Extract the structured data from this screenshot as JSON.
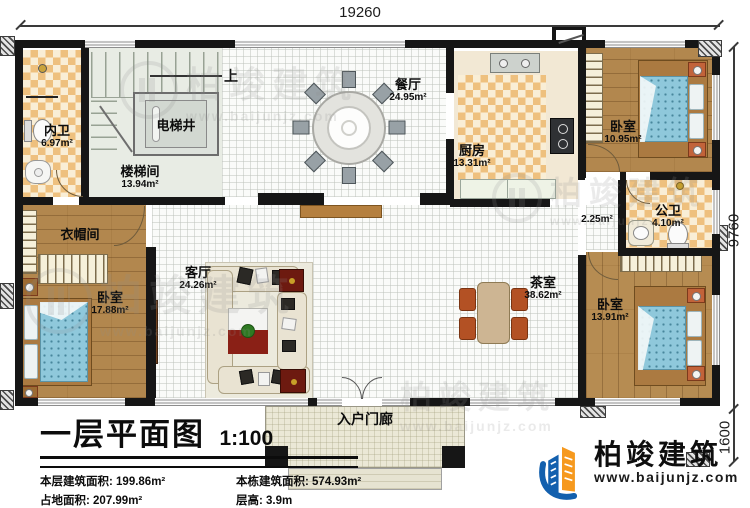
{
  "title_block": {
    "title": "一层平面图",
    "scale": "1:100",
    "stats": [
      {
        "label": "本层建筑面积: ",
        "value": "199.86m²"
      },
      {
        "label": "本栋建筑面积: ",
        "value": "574.93m²"
      },
      {
        "label": "占地面积: ",
        "value": "207.99m²"
      },
      {
        "label": "层高: ",
        "value": "3.9m"
      }
    ],
    "note": "注: 阳台算半面积，露台不算面积"
  },
  "dimensions": {
    "top_width": "19260",
    "right_height": "9760",
    "porch_depth": "1600"
  },
  "stairs": {
    "up_label": "上"
  },
  "rooms": [
    {
      "name": "内卫",
      "area": "6.97m²"
    },
    {
      "name": "电梯井",
      "area": ""
    },
    {
      "name": "楼梯间",
      "area": "13.94m²"
    },
    {
      "name": "餐厅",
      "area": "24.95m²"
    },
    {
      "name": "厨房",
      "area": "13.31m²"
    },
    {
      "name": "卧室",
      "area": "10.95m²"
    },
    {
      "name": "",
      "area": "2.25m²"
    },
    {
      "name": "公卫",
      "area": "4.10m²"
    },
    {
      "name": "衣帽间",
      "area": ""
    },
    {
      "name": "卧室",
      "area": "17.88m²"
    },
    {
      "name": "客厅",
      "area": "24.26m²"
    },
    {
      "name": "茶室",
      "area": "38.62m²"
    },
    {
      "name": "卧室",
      "area": "13.91m²"
    },
    {
      "name": "入户门廊",
      "area": ""
    }
  ],
  "brand": {
    "name": "柏竣建筑",
    "website": "www.baijunjz.com"
  }
}
